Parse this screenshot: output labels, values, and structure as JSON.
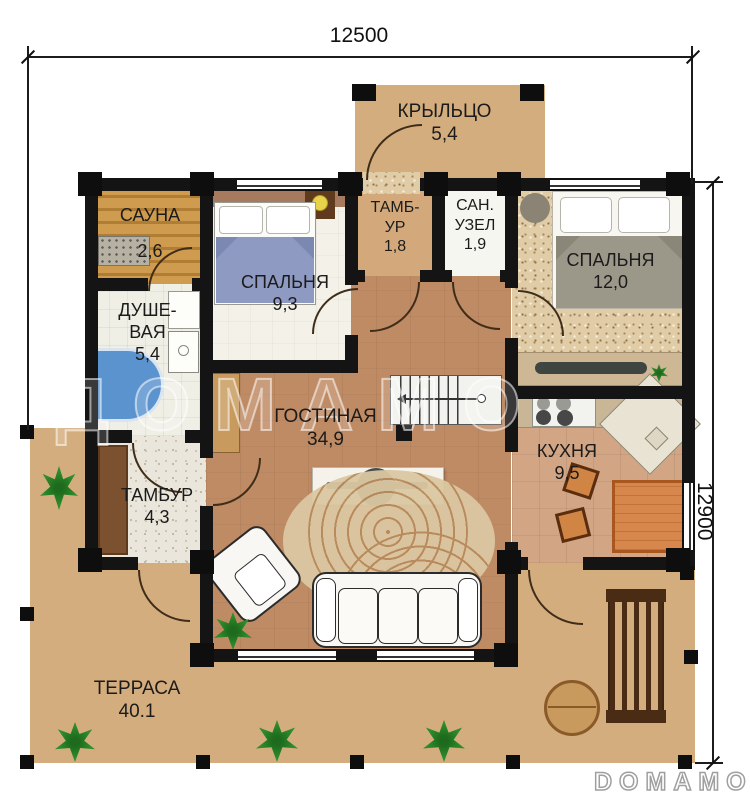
{
  "plan": {
    "dim_width": "12500",
    "dim_height": "12900",
    "watermark_center": "ДОМАМО",
    "watermark_logo": "DOMAMO",
    "rooms": {
      "porch": {
        "name": "КРЫЛЬЦО",
        "area": "5,4"
      },
      "sauna": {
        "name": "САУНА",
        "area": "2,6"
      },
      "bedroom1": {
        "name": "СПАЛЬНЯ",
        "area": "9,3"
      },
      "tambour1": {
        "name": "ТАМБ-\nУР",
        "area": "1,8"
      },
      "wc": {
        "name": "САН.\nУЗЕЛ",
        "area": "1,9"
      },
      "bedroom2": {
        "name": "СПАЛЬНЯ",
        "area": "12,0"
      },
      "shower": {
        "name": "ДУШЕ-\nВАЯ",
        "area": "5,4"
      },
      "living": {
        "name": "ГОСТИНАЯ",
        "area": "34,9"
      },
      "kitchen": {
        "name": "КУХНЯ",
        "area": "9,5"
      },
      "tambour2": {
        "name": "ТАМБУР",
        "area": "4,3"
      },
      "terrace": {
        "name": "ТЕРРАСА",
        "area": "40.1"
      }
    },
    "colors": {
      "terrace": "#d4ad7e",
      "living_floor": "#bf8b64",
      "kitchen_floor": "#d2a685",
      "wall": "#141414",
      "table_orange": "#d7874b",
      "plant_green": "#2f8f2c",
      "bed1_blanket": "#8e9ac2",
      "bed2_blanket": "#9c9889",
      "shower_blue": "#5b93cf"
    }
  }
}
